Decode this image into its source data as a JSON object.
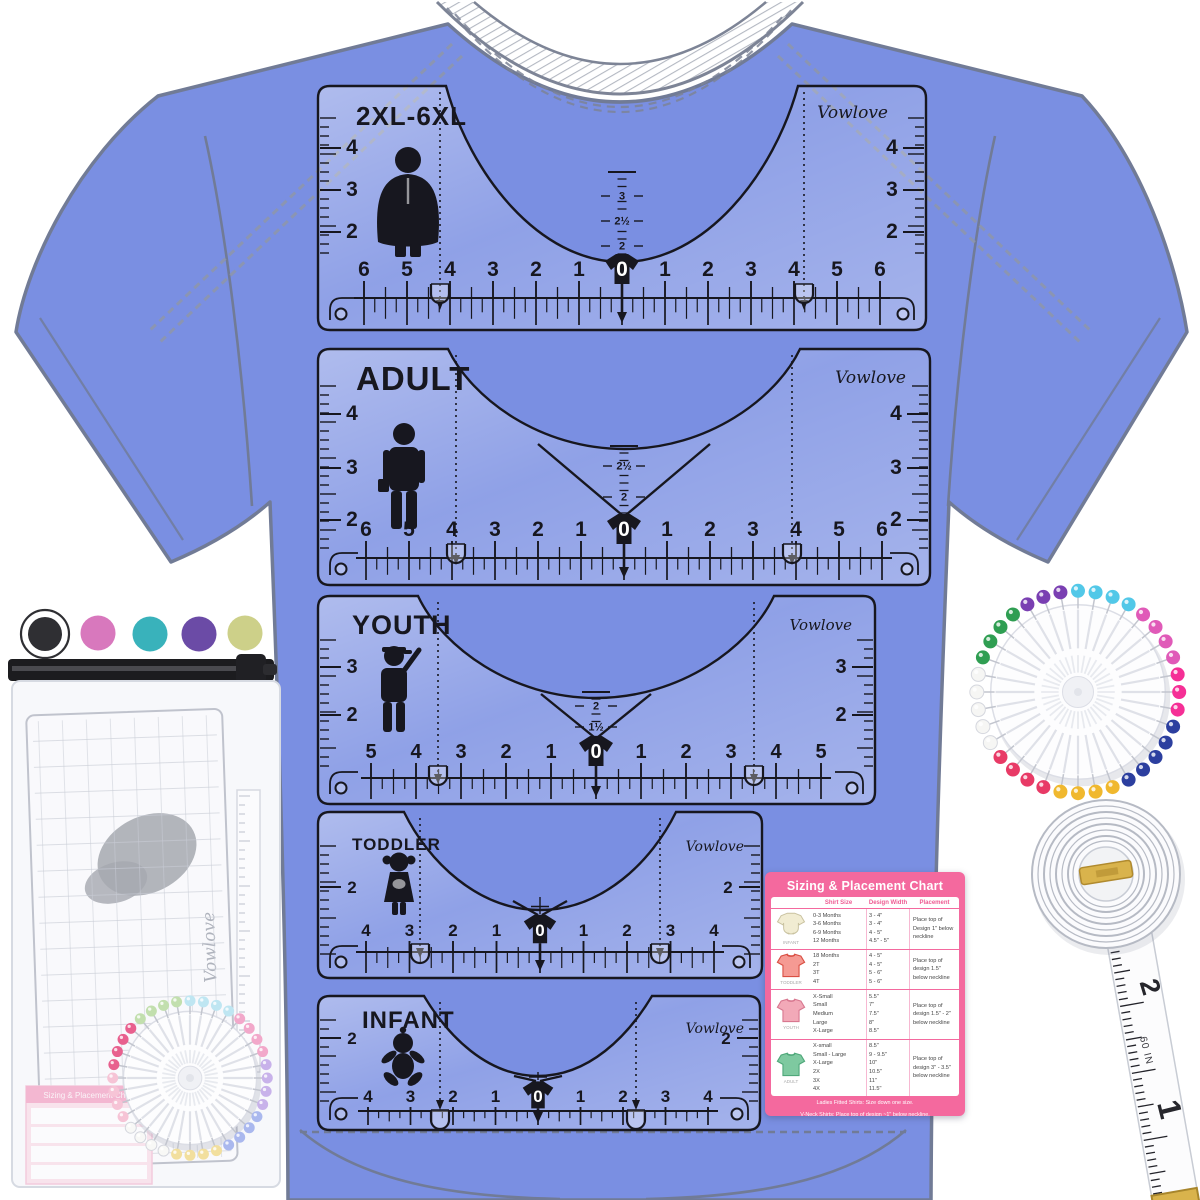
{
  "brand": "Vowlove",
  "colors": {
    "shirt_blue": "#7a8fe2",
    "ruler_ink": "#17171f",
    "chart_pink": "#f4699e"
  },
  "rulers": [
    {
      "label": "2XL-6XL",
      "brand": "Vowlove",
      "icon": "plus-size-adult-icon",
      "side_scale": [
        "4",
        "3",
        "2"
      ],
      "bottom_scale": [
        "6",
        "5",
        "4",
        "3",
        "2",
        "1",
        "0",
        "1",
        "2",
        "3",
        "4",
        "5",
        "6"
      ],
      "center_scale": [
        "3",
        "2½",
        "2"
      ]
    },
    {
      "label": "ADULT",
      "brand": "Vowlove",
      "icon": "adult-man-icon",
      "side_scale": [
        "4",
        "3",
        "2"
      ],
      "bottom_scale": [
        "6",
        "5",
        "4",
        "3",
        "2",
        "1",
        "0",
        "1",
        "2",
        "3",
        "4",
        "5",
        "6"
      ],
      "center_scale": [
        "2½",
        "2"
      ]
    },
    {
      "label": "YOUTH",
      "brand": "Vowlove",
      "icon": "youth-boy-icon",
      "side_scale": [
        "3",
        "2"
      ],
      "bottom_scale": [
        "5",
        "4",
        "3",
        "2",
        "1",
        "0",
        "1",
        "2",
        "3",
        "4",
        "5"
      ],
      "center_scale": [
        "2",
        "1½"
      ]
    },
    {
      "label": "TODDLER",
      "brand": "Vowlove",
      "icon": "toddler-girl-icon",
      "side_scale": [
        "2"
      ],
      "bottom_scale": [
        "4",
        "3",
        "2",
        "1",
        "0",
        "1",
        "2",
        "3",
        "4"
      ],
      "center_scale": []
    },
    {
      "label": "INFANT",
      "brand": "Vowlove",
      "icon": "baby-icon",
      "side_scale": [
        "2"
      ],
      "bottom_scale": [
        "4",
        "3",
        "2",
        "1",
        "0",
        "1",
        "2",
        "3",
        "4"
      ],
      "center_scale": []
    }
  ],
  "chart": {
    "title": "Sizing & Placement Chart",
    "columns": [
      "Shirt Size",
      "Design Width",
      "Placement"
    ],
    "rows": [
      {
        "icon": "infant-onesie-icon",
        "icon_label": "INFANT",
        "sizes": [
          "0-3 Months",
          "3-6 Months",
          "6-9 Months",
          "12 Months"
        ],
        "widths": [
          "3 - 4\"",
          "3 - 4\"",
          "4 - 5\"",
          "4.5\" - 5\""
        ],
        "placement": "Place top of Design 1\" below neckline"
      },
      {
        "icon": "toddler-shirt-icon",
        "icon_label": "TODDLER",
        "sizes": [
          "18 Months",
          "2T",
          "3T",
          "4T"
        ],
        "widths": [
          "4 - 5\"",
          "4 - 5\"",
          "5 - 6\"",
          "5 - 6\""
        ],
        "placement": "Place top of design 1.5\" below neckline"
      },
      {
        "icon": "youth-shirt-icon",
        "icon_label": "YOUTH",
        "sizes": [
          "X-Small",
          "Small",
          "Medium",
          "Large",
          "X-Large"
        ],
        "widths": [
          "5.5\"",
          "7\"",
          "7.5\"",
          "8\"",
          "8.5\""
        ],
        "placement": "Place top of design 1.5\" - 2\" below neckline"
      },
      {
        "icon": "adult-shirt-icon",
        "icon_label": "ADULT",
        "sizes": [
          "X-small",
          "Small - Large",
          "X-Large",
          "2X",
          "3X",
          "4X"
        ],
        "widths": [
          "8.5\"",
          "9 - 9.5\"",
          "10\"",
          "10.5\"",
          "11\"",
          "11.5\""
        ],
        "placement": "Place top of design 3\" - 3.5\" below neckline"
      }
    ],
    "footnotes": [
      "Ladies Fitted Shirts: Size down one size.",
      "V-Neck Shirts: Place top of design ~1\" below neckline.",
      "Width of Pocket Design: 3\" for Youth, 4\" for Adults (S, M) & Jerseys, 5\" for Adults (L & above)"
    ]
  },
  "tape": {
    "labels": {
      "two": "2",
      "sixty": "60 IN",
      "one": "1"
    }
  },
  "pins": {
    "wheel": {
      "groups": [
        {
          "color": "#52c8e8",
          "count": 4
        },
        {
          "color": "#e05ab8",
          "count": 4
        },
        {
          "color": "#f52f96",
          "count": 3
        },
        {
          "color": "#2c3f9f",
          "count": 5
        },
        {
          "color": "#f0b82e",
          "count": 4
        },
        {
          "color": "#e83a66",
          "count": 4
        },
        {
          "color": "#f6f6f4",
          "count": 5
        },
        {
          "color": "#2f9e52",
          "count": 4
        },
        {
          "color": "#7a3fb2",
          "count": 3
        }
      ]
    },
    "wheel_small": {
      "groups": [
        {
          "color": "#bfe6f2",
          "count": 4
        },
        {
          "color": "#f2a8ca",
          "count": 4
        },
        {
          "color": "#c8b2ea",
          "count": 4
        },
        {
          "color": "#aab8ee",
          "count": 4
        },
        {
          "color": "#f2df9e",
          "count": 4
        },
        {
          "color": "#f8f8f6",
          "count": 4
        },
        {
          "color": "#f6c4d6",
          "count": 4
        },
        {
          "color": "#e8608e",
          "count": 4
        },
        {
          "color": "#c2dfae",
          "count": 4
        }
      ]
    }
  },
  "bag": {
    "dot_colors": [
      "#2f2f33",
      "#d878bd",
      "#39b2bb",
      "#6b4ba6",
      "#cdd089"
    ]
  }
}
